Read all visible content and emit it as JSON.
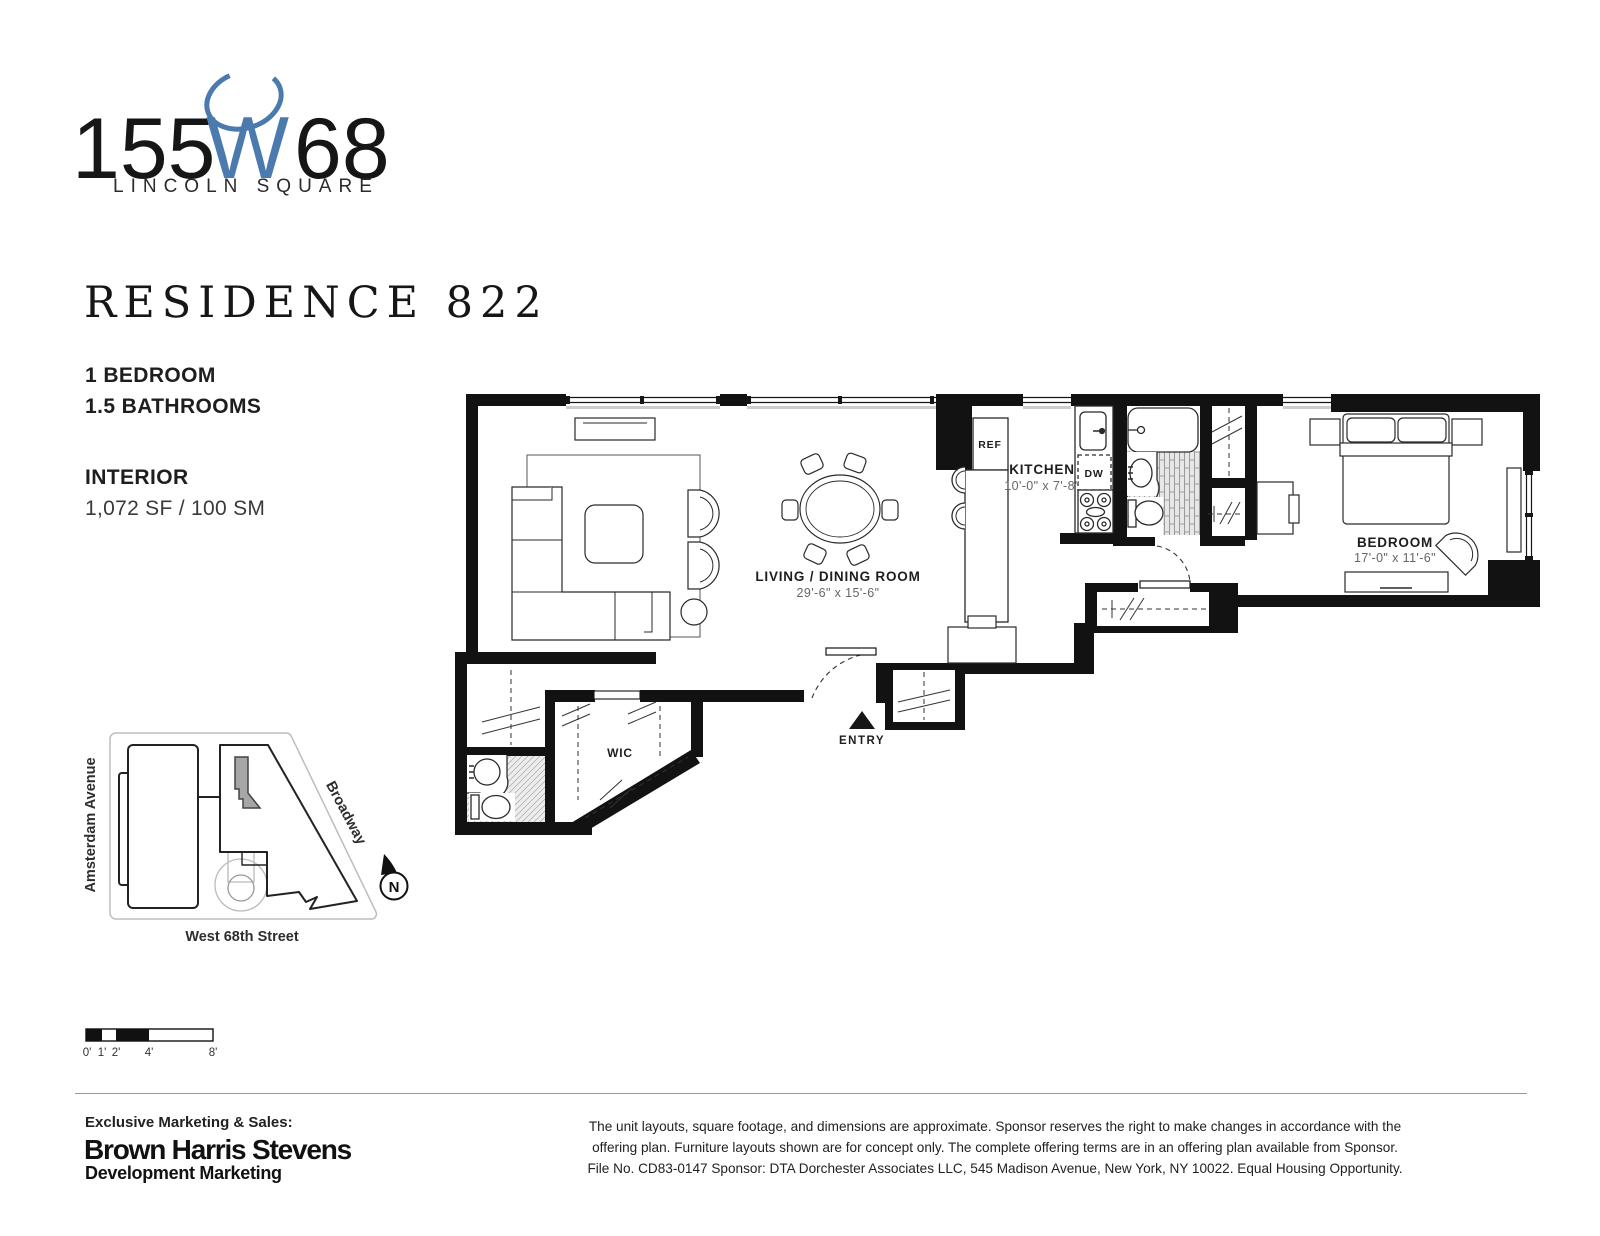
{
  "brand": {
    "num1": "155",
    "w": "W",
    "num2": "68",
    "tagline": "LINCOLN SQUARE"
  },
  "residence": {
    "title": "RESIDENCE 822",
    "bedrooms": "1 BEDROOM",
    "bathrooms": "1.5 BATHROOMS",
    "interior_label": "INTERIOR",
    "interior_area": "1,072 SF / 100 SM"
  },
  "floorplan": {
    "living": {
      "name": "LIVING / DINING ROOM",
      "dims": "29'-6\" x 15'-6\""
    },
    "kitchen": {
      "name": "KITCHEN",
      "dims": "10'-0\" x 7'-8\""
    },
    "bedroom": {
      "name": "BEDROOM",
      "dims": "17'-0\" x 11'-6\""
    },
    "wic_label": "WIC",
    "entry_label": "ENTRY",
    "ref_label": "REF",
    "dw_label": "DW"
  },
  "site_map": {
    "street_left": "Amsterdam Avenue",
    "street_right": "Broadway",
    "street_bottom": "West 68th Street",
    "north_label": "N"
  },
  "scale_bar": {
    "labels": [
      "0'",
      "1'",
      "2'",
      "4'",
      "8'"
    ]
  },
  "footer": {
    "exclusive_label": "Exclusive Marketing & Sales:",
    "brokerage_name": "Brown Harris Stevens",
    "brokerage_division": "Development Marketing",
    "disclaimer_line1": "The unit layouts, square footage, and dimensions are approximate. Sponsor reserves the right to make changes in accordance with the",
    "disclaimer_line2": "offering plan. Furniture layouts shown are for concept only. The complete offering terms are in an offering plan available from Sponsor.",
    "disclaimer_line3": "File No. CD83-0147 Sponsor: DTA Dorchester Associates LLC, 545 Madison Avenue, New York, NY 10022. Equal Housing Opportunity."
  },
  "colors": {
    "accent_blue": "#4a7aae",
    "ink": "#161616"
  }
}
